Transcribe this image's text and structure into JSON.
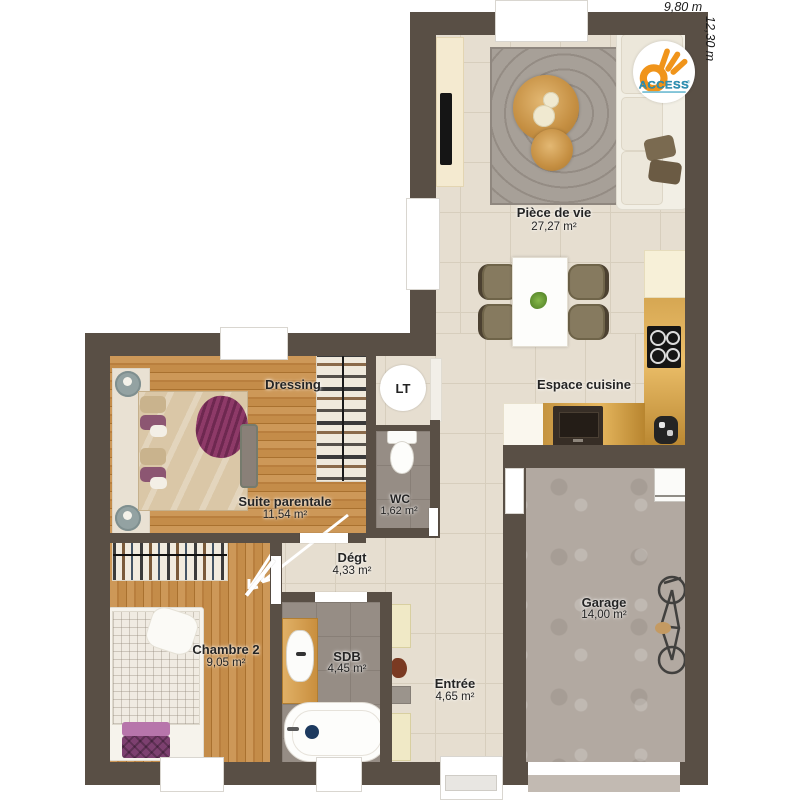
{
  "plan": {
    "dim_width": "9,80 m",
    "dim_height": "12,30 m"
  },
  "logo": {
    "text": "ACCESS",
    "registered": "®"
  },
  "rooms": {
    "piece_de_vie": {
      "name": "Pièce de vie",
      "area": "27,27 m²"
    },
    "espace_cuisine": {
      "name": "Espace cuisine"
    },
    "dressing": {
      "name": "Dressing"
    },
    "lt": {
      "name": "LT"
    },
    "suite_parentale": {
      "name": "Suite parentale",
      "area": "11,54 m²"
    },
    "wc": {
      "name": "WC",
      "area": "1,62 m²"
    },
    "degt": {
      "name": "Dégt",
      "area": "4,33 m²"
    },
    "chambre_2": {
      "name": "Chambre 2",
      "area": "9,05 m²"
    },
    "sdb": {
      "name": "SDB",
      "area": "4,45 m²"
    },
    "entree": {
      "name": "Entrée",
      "area": "4,65 m²"
    },
    "garage": {
      "name": "Garage",
      "area": "14,00 m²"
    }
  },
  "colors": {
    "wall": "#594f45",
    "tile": "#e6ded0",
    "wood": "#c18a4b",
    "gray_tile": "#968d85",
    "concrete": "#b2a9a1",
    "logo_orange": "#f0941a",
    "logo_teal": "#2e96b8"
  }
}
